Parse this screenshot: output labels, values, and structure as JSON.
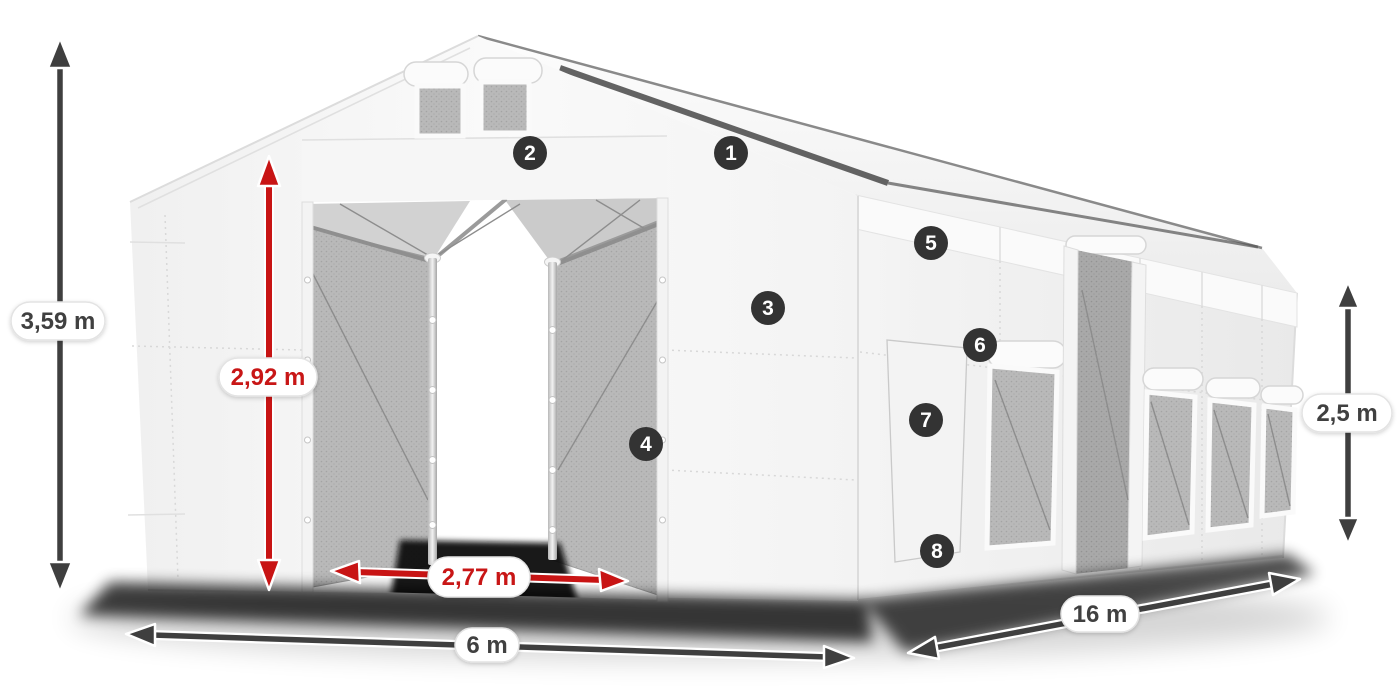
{
  "dimensions": {
    "total_height": {
      "label": "3,59 m",
      "color": "#3f3f3f"
    },
    "entrance_height": {
      "label": "2,92 m",
      "color": "#c81414"
    },
    "entrance_width": {
      "label": "2,77 m",
      "color": "#c81414"
    },
    "width": {
      "label": "6 m",
      "color": "#3f3f3f"
    },
    "length": {
      "label": "16 m",
      "color": "#3f3f3f"
    },
    "side_height": {
      "label": "2,5 m",
      "color": "#3f3f3f"
    }
  },
  "markers": [
    {
      "number": "1"
    },
    {
      "number": "2"
    },
    {
      "number": "3"
    },
    {
      "number": "4"
    },
    {
      "number": "5"
    },
    {
      "number": "6"
    },
    {
      "number": "7"
    },
    {
      "number": "8"
    }
  ],
  "colors": {
    "background": "#ffffff",
    "annotation_dark": "#3f3f3f",
    "annotation_red": "#c81414",
    "marker_bg": "#333333",
    "marker_text": "#ffffff",
    "label_bg": "#ffffff",
    "tent_white": "#f5f5f5",
    "mesh_gray": "#b9b9b9",
    "shadow": "#000000"
  }
}
